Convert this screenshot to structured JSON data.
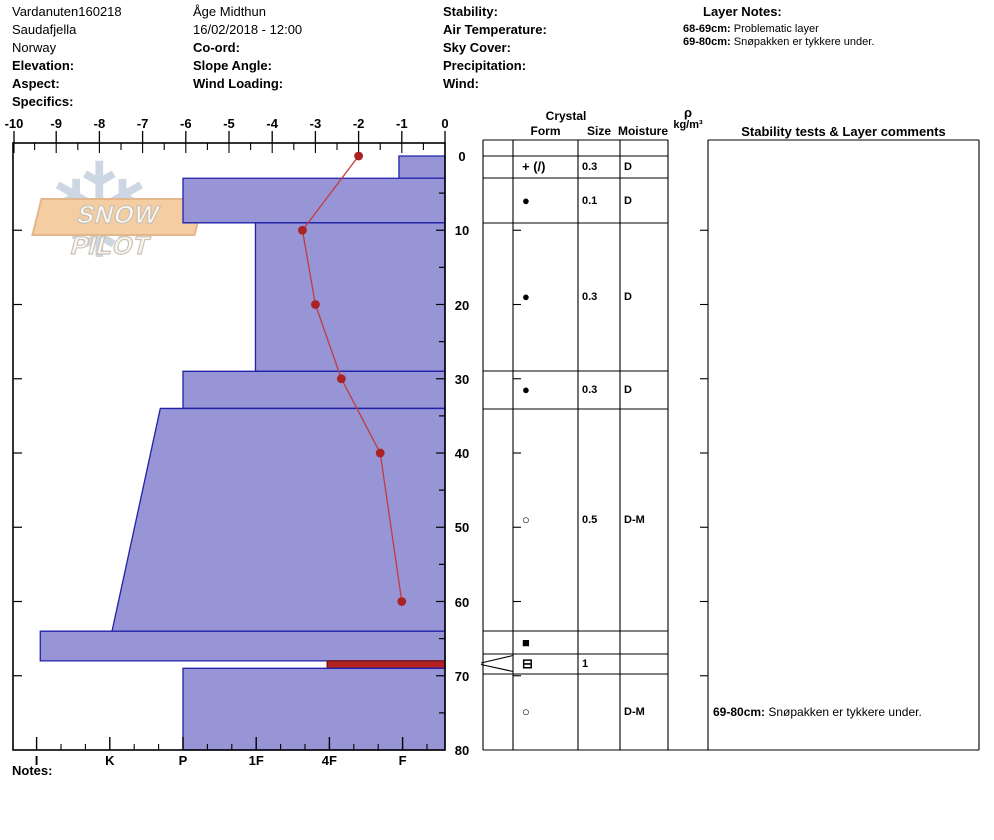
{
  "header": {
    "col1": {
      "line1": "Vardanuten160218",
      "line2": "Saudafjella",
      "line3": "Norway",
      "elevation_label": "Elevation:",
      "aspect_label": "Aspect:",
      "specifics_label": "Specifics:"
    },
    "col2": {
      "observer": "Åge Midthun",
      "datetime": "16/02/2018 - 12:00",
      "coord_label": "Co-ord:",
      "slope_angle_label": "Slope Angle:",
      "wind_loading_label": "Wind Loading:"
    },
    "col3": {
      "stability_label": "Stability:",
      "air_temperature_label": "Air Temperature:",
      "sky_cover_label": "Sky Cover:",
      "precipitation_label": "Precipitation:",
      "wind_label": "Wind:"
    },
    "layer_notes": {
      "title": "Layer Notes:",
      "notes": [
        {
          "range": "68-69cm:",
          "text": " Problematic layer"
        },
        {
          "range": "69-80cm:",
          "text": " Snøpakken er tykkere under."
        }
      ]
    }
  },
  "logo": {
    "text": "SNOW PILOT",
    "snowflake_glyph": "❄"
  },
  "chart_data": {
    "type": "snow-profile",
    "depth_axis": {
      "unit": "cm",
      "range": [
        0,
        80
      ],
      "labels": [
        0,
        10,
        20,
        30,
        40,
        50,
        60,
        70,
        80
      ]
    },
    "temp_axis": {
      "unit": "°C",
      "range": [
        -10,
        0
      ],
      "ticks": [
        -10,
        -9,
        -8,
        -7,
        -6,
        -5,
        -4,
        -3,
        -2,
        -1,
        0
      ]
    },
    "hardness_axis": {
      "categories": [
        "I",
        "K",
        "P",
        "1F",
        "4F",
        "F"
      ]
    },
    "layers": [
      {
        "top_cm": 0,
        "bottom_cm": 3,
        "hardness": "F",
        "h_index": 4.95
      },
      {
        "top_cm": 3,
        "bottom_cm": 9,
        "hardness": "P",
        "h_index": 2.0
      },
      {
        "top_cm": 9,
        "bottom_cm": 29,
        "hardness": "1F",
        "h_index": 2.99
      },
      {
        "top_cm": 29,
        "bottom_cm": 34,
        "hardness": "P",
        "h_index": 2.0
      },
      {
        "top_cm": 34,
        "bottom_cm": 64,
        "hardness_top": "P-",
        "hardness_bottom": "K",
        "h_index": 1.69,
        "h_index_bottom": 1.03
      },
      {
        "top_cm": 64,
        "bottom_cm": 68,
        "hardness": "I",
        "h_index": 0.05
      },
      {
        "top_cm": 68,
        "bottom_cm": 69,
        "hardness": "4F",
        "h_index": 3.97,
        "problematic": true
      },
      {
        "top_cm": 69,
        "bottom_cm": 80,
        "hardness": "P",
        "h_index": 2.0
      }
    ],
    "temperature_series": [
      {
        "depth_cm": 0,
        "temp_c": -2.0
      },
      {
        "depth_cm": 10,
        "temp_c": -3.3
      },
      {
        "depth_cm": 20,
        "temp_c": -3.0
      },
      {
        "depth_cm": 30,
        "temp_c": -2.4
      },
      {
        "depth_cm": 40,
        "temp_c": -1.5
      },
      {
        "depth_cm": 60,
        "temp_c": -1.0
      }
    ]
  },
  "table": {
    "headers": {
      "crystal": "Crystal",
      "form": "Form",
      "size": "Size",
      "moisture": "Moisture",
      "rho_symbol": "ρ",
      "rho_unit": "kg/m³",
      "stability": "Stability tests & Layer comments"
    },
    "rows": [
      {
        "range_cm": "0-3",
        "form": "+ (/)",
        "size": "0.3",
        "moisture": "D"
      },
      {
        "range_cm": "3-9",
        "form": "●",
        "size": "0.1",
        "moisture": "D"
      },
      {
        "range_cm": "9-29",
        "form": "●",
        "size": "0.3",
        "moisture": "D"
      },
      {
        "range_cm": "29-34",
        "form": "●",
        "size": "0.3",
        "moisture": "D"
      },
      {
        "range_cm": "34-64",
        "form": "○",
        "size": "0.5",
        "moisture": "D-M"
      },
      {
        "range_cm": "64-68",
        "form": "■",
        "size": "",
        "moisture": ""
      },
      {
        "range_cm": "68-69",
        "form": "⊟",
        "size": "1",
        "moisture": ""
      },
      {
        "range_cm": "69-80",
        "form": "○",
        "size": "",
        "moisture": "D-M",
        "comment": {
          "range": "69-80cm:",
          "text": " Snøpakken er tykkere under."
        }
      }
    ]
  },
  "notes_label": "Notes:",
  "colors": {
    "bar_fill": "#9795d6",
    "bar_stroke": "#2121aa",
    "problem_fill": "#b22222",
    "problem_stroke": "#7a1010",
    "temp_line": "#c33b3b",
    "temp_dot": "#aa2222",
    "grid": "#000000",
    "logo_flake": "#ccd7e3",
    "logo_band": "#f5cda3"
  }
}
